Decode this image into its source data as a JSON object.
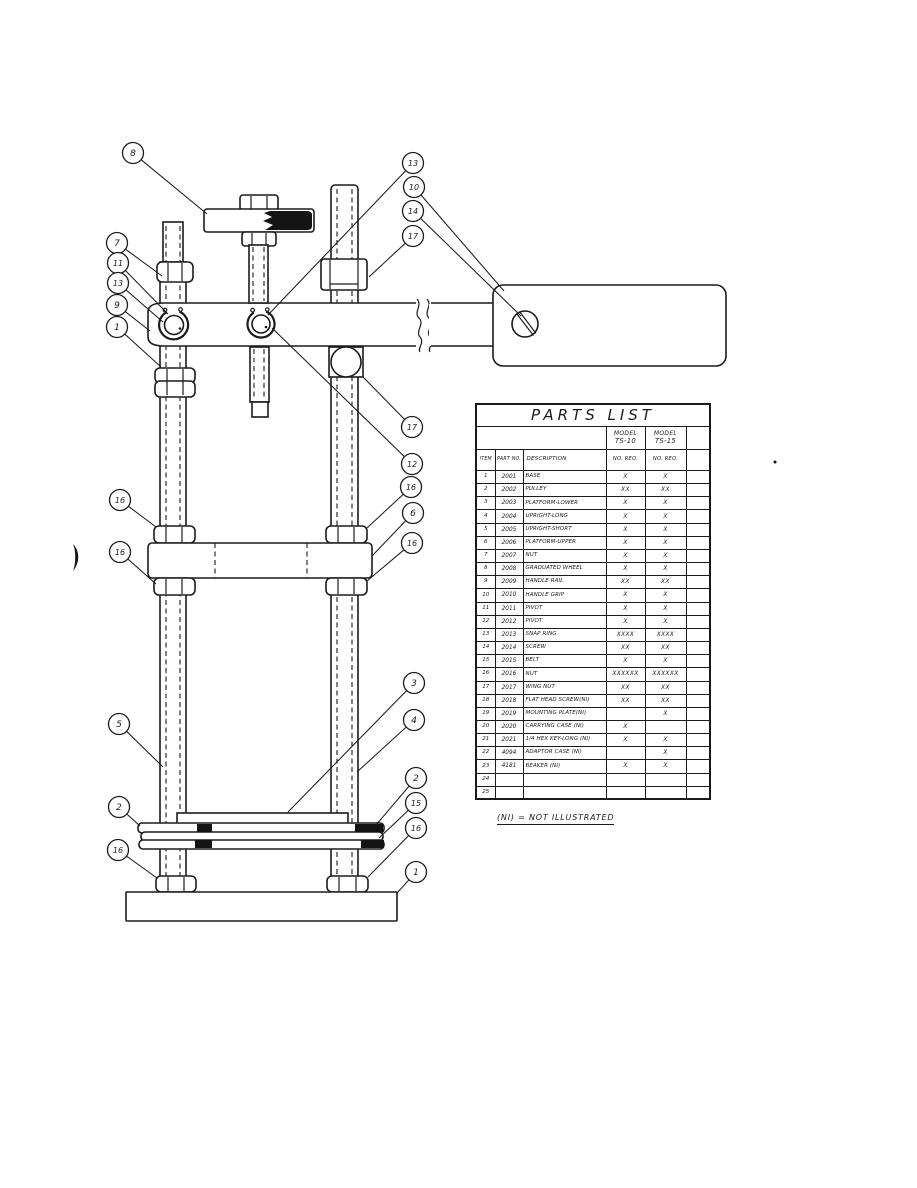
{
  "page": {
    "note": "(NI) = NOT ILLUSTRATED",
    "colors": {
      "ink": "#1b1b1b",
      "paper": "#ffffff"
    }
  },
  "parts_table": {
    "title": "PARTS LIST",
    "model_columns": [
      {
        "line1": "MODEL",
        "line2": "TS-10"
      },
      {
        "line1": "MODEL",
        "line2": "TS-15"
      }
    ],
    "column_headers": [
      "ITEM",
      "PART NO.",
      "DESCRIPTION",
      "NO. REQ.",
      "NO. REQ.",
      ""
    ],
    "rows": [
      [
        "1",
        "2001",
        "BASE",
        "X",
        "X"
      ],
      [
        "2",
        "2002",
        "PULLEY",
        "XX",
        "XX"
      ],
      [
        "3",
        "2003",
        "PLATFORM-LOWER",
        "X",
        "X"
      ],
      [
        "4",
        "2004",
        "UPRIGHT-LONG",
        "X",
        "X"
      ],
      [
        "5",
        "2005",
        "UPRIGHT-SHORT",
        "X",
        "X"
      ],
      [
        "6",
        "2006",
        "PLATFORM-UPPER",
        "X",
        "X"
      ],
      [
        "7",
        "2007",
        "NUT",
        "X",
        "X"
      ],
      [
        "8",
        "2008",
        "GRADUATED WHEEL",
        "X",
        "X"
      ],
      [
        "9",
        "2009",
        "HANDLE RAIL",
        "XX",
        "XX"
      ],
      [
        "10",
        "2010",
        "HANDLE GRIP",
        "X",
        "X"
      ],
      [
        "11",
        "2011",
        "PIVOT",
        "X",
        "X"
      ],
      [
        "12",
        "2012",
        "PIVOT",
        "X",
        "X"
      ],
      [
        "13",
        "2013",
        "SNAP RING",
        "XXXX",
        "XXXX"
      ],
      [
        "14",
        "2014",
        "SCREW",
        "XX",
        "XX"
      ],
      [
        "15",
        "2015",
        "BELT",
        "X",
        "X"
      ],
      [
        "16",
        "2016",
        "NUT",
        "XXXXXX",
        "XXXXXX"
      ],
      [
        "17",
        "2017",
        "WING NUT",
        "XX",
        "XX"
      ],
      [
        "18",
        "2018",
        "FLAT HEAD SCREW(NI)",
        "XX",
        "XX"
      ],
      [
        "19",
        "2019",
        "MOUNTING PLATE(NI)",
        "",
        "X"
      ],
      [
        "20",
        "2020",
        "CARRYING CASE  (NI)",
        "X",
        ""
      ],
      [
        "21",
        "2021",
        "1/4 HEX KEY-LONG (NI)",
        "X",
        "X"
      ],
      [
        "22",
        "4094",
        "ADAPTOR CASE  (NI)",
        "",
        "X"
      ],
      [
        "23",
        "4181",
        "BEAKER        (NI)",
        "X",
        "X"
      ],
      [
        "24",
        "",
        "",
        "",
        ""
      ],
      [
        "25",
        "",
        "",
        "",
        ""
      ]
    ]
  },
  "diagram": {
    "callouts": [
      {
        "label": "8",
        "cx": 133,
        "cy": 153,
        "tx": 207,
        "ty": 214
      },
      {
        "label": "7",
        "cx": 117,
        "cy": 243,
        "tx": 162,
        "ty": 276
      },
      {
        "label": "11",
        "cx": 118,
        "cy": 263,
        "tx": 168,
        "ty": 314
      },
      {
        "label": "13",
        "cx": 118,
        "cy": 283,
        "tx": 163,
        "ty": 322
      },
      {
        "label": "9",
        "cx": 117,
        "cy": 305,
        "tx": 150,
        "ty": 331
      },
      {
        "label": "1",
        "cx": 117,
        "cy": 327,
        "tx": 161,
        "ty": 367
      },
      {
        "label": "16",
        "cx": 120,
        "cy": 500,
        "tx": 156,
        "ty": 527
      },
      {
        "label": "16",
        "cx": 120,
        "cy": 552,
        "tx": 156,
        "ty": 584
      },
      {
        "label": "5",
        "cx": 119,
        "cy": 724,
        "tx": 163,
        "ty": 767
      },
      {
        "label": "2",
        "cx": 119,
        "cy": 807,
        "tx": 140,
        "ty": 826
      },
      {
        "label": "16",
        "cx": 118,
        "cy": 850,
        "tx": 157,
        "ty": 878
      },
      {
        "label": "13",
        "cx": 413,
        "cy": 163,
        "tx": 268,
        "ty": 315
      },
      {
        "label": "10",
        "cx": 414,
        "cy": 187,
        "tx": 504,
        "ty": 291
      },
      {
        "label": "14",
        "cx": 413,
        "cy": 211,
        "tx": 521,
        "ty": 316
      },
      {
        "label": "17",
        "cx": 413,
        "cy": 236,
        "tx": 369,
        "ty": 277
      },
      {
        "label": "17",
        "cx": 412,
        "cy": 427,
        "tx": 363,
        "ty": 377
      },
      {
        "label": "12",
        "cx": 412,
        "cy": 464,
        "tx": 272,
        "ty": 328
      },
      {
        "label": "16",
        "cx": 411,
        "cy": 487,
        "tx": 367,
        "ty": 528
      },
      {
        "label": "6",
        "cx": 413,
        "cy": 513,
        "tx": 372,
        "ty": 556
      },
      {
        "label": "16",
        "cx": 412,
        "cy": 543,
        "tx": 367,
        "ty": 581
      },
      {
        "label": "3",
        "cx": 414,
        "cy": 683,
        "tx": 288,
        "ty": 812
      },
      {
        "label": "4",
        "cx": 414,
        "cy": 720,
        "tx": 357,
        "ty": 772
      },
      {
        "label": "2",
        "cx": 416,
        "cy": 778,
        "tx": 376,
        "ty": 825
      },
      {
        "label": "15",
        "cx": 416,
        "cy": 803,
        "tx": 379,
        "ty": 838
      },
      {
        "label": "16",
        "cx": 416,
        "cy": 828,
        "tx": 368,
        "ty": 877
      },
      {
        "label": "1",
        "cx": 416,
        "cy": 872,
        "tx": 397,
        "ty": 893
      }
    ]
  }
}
